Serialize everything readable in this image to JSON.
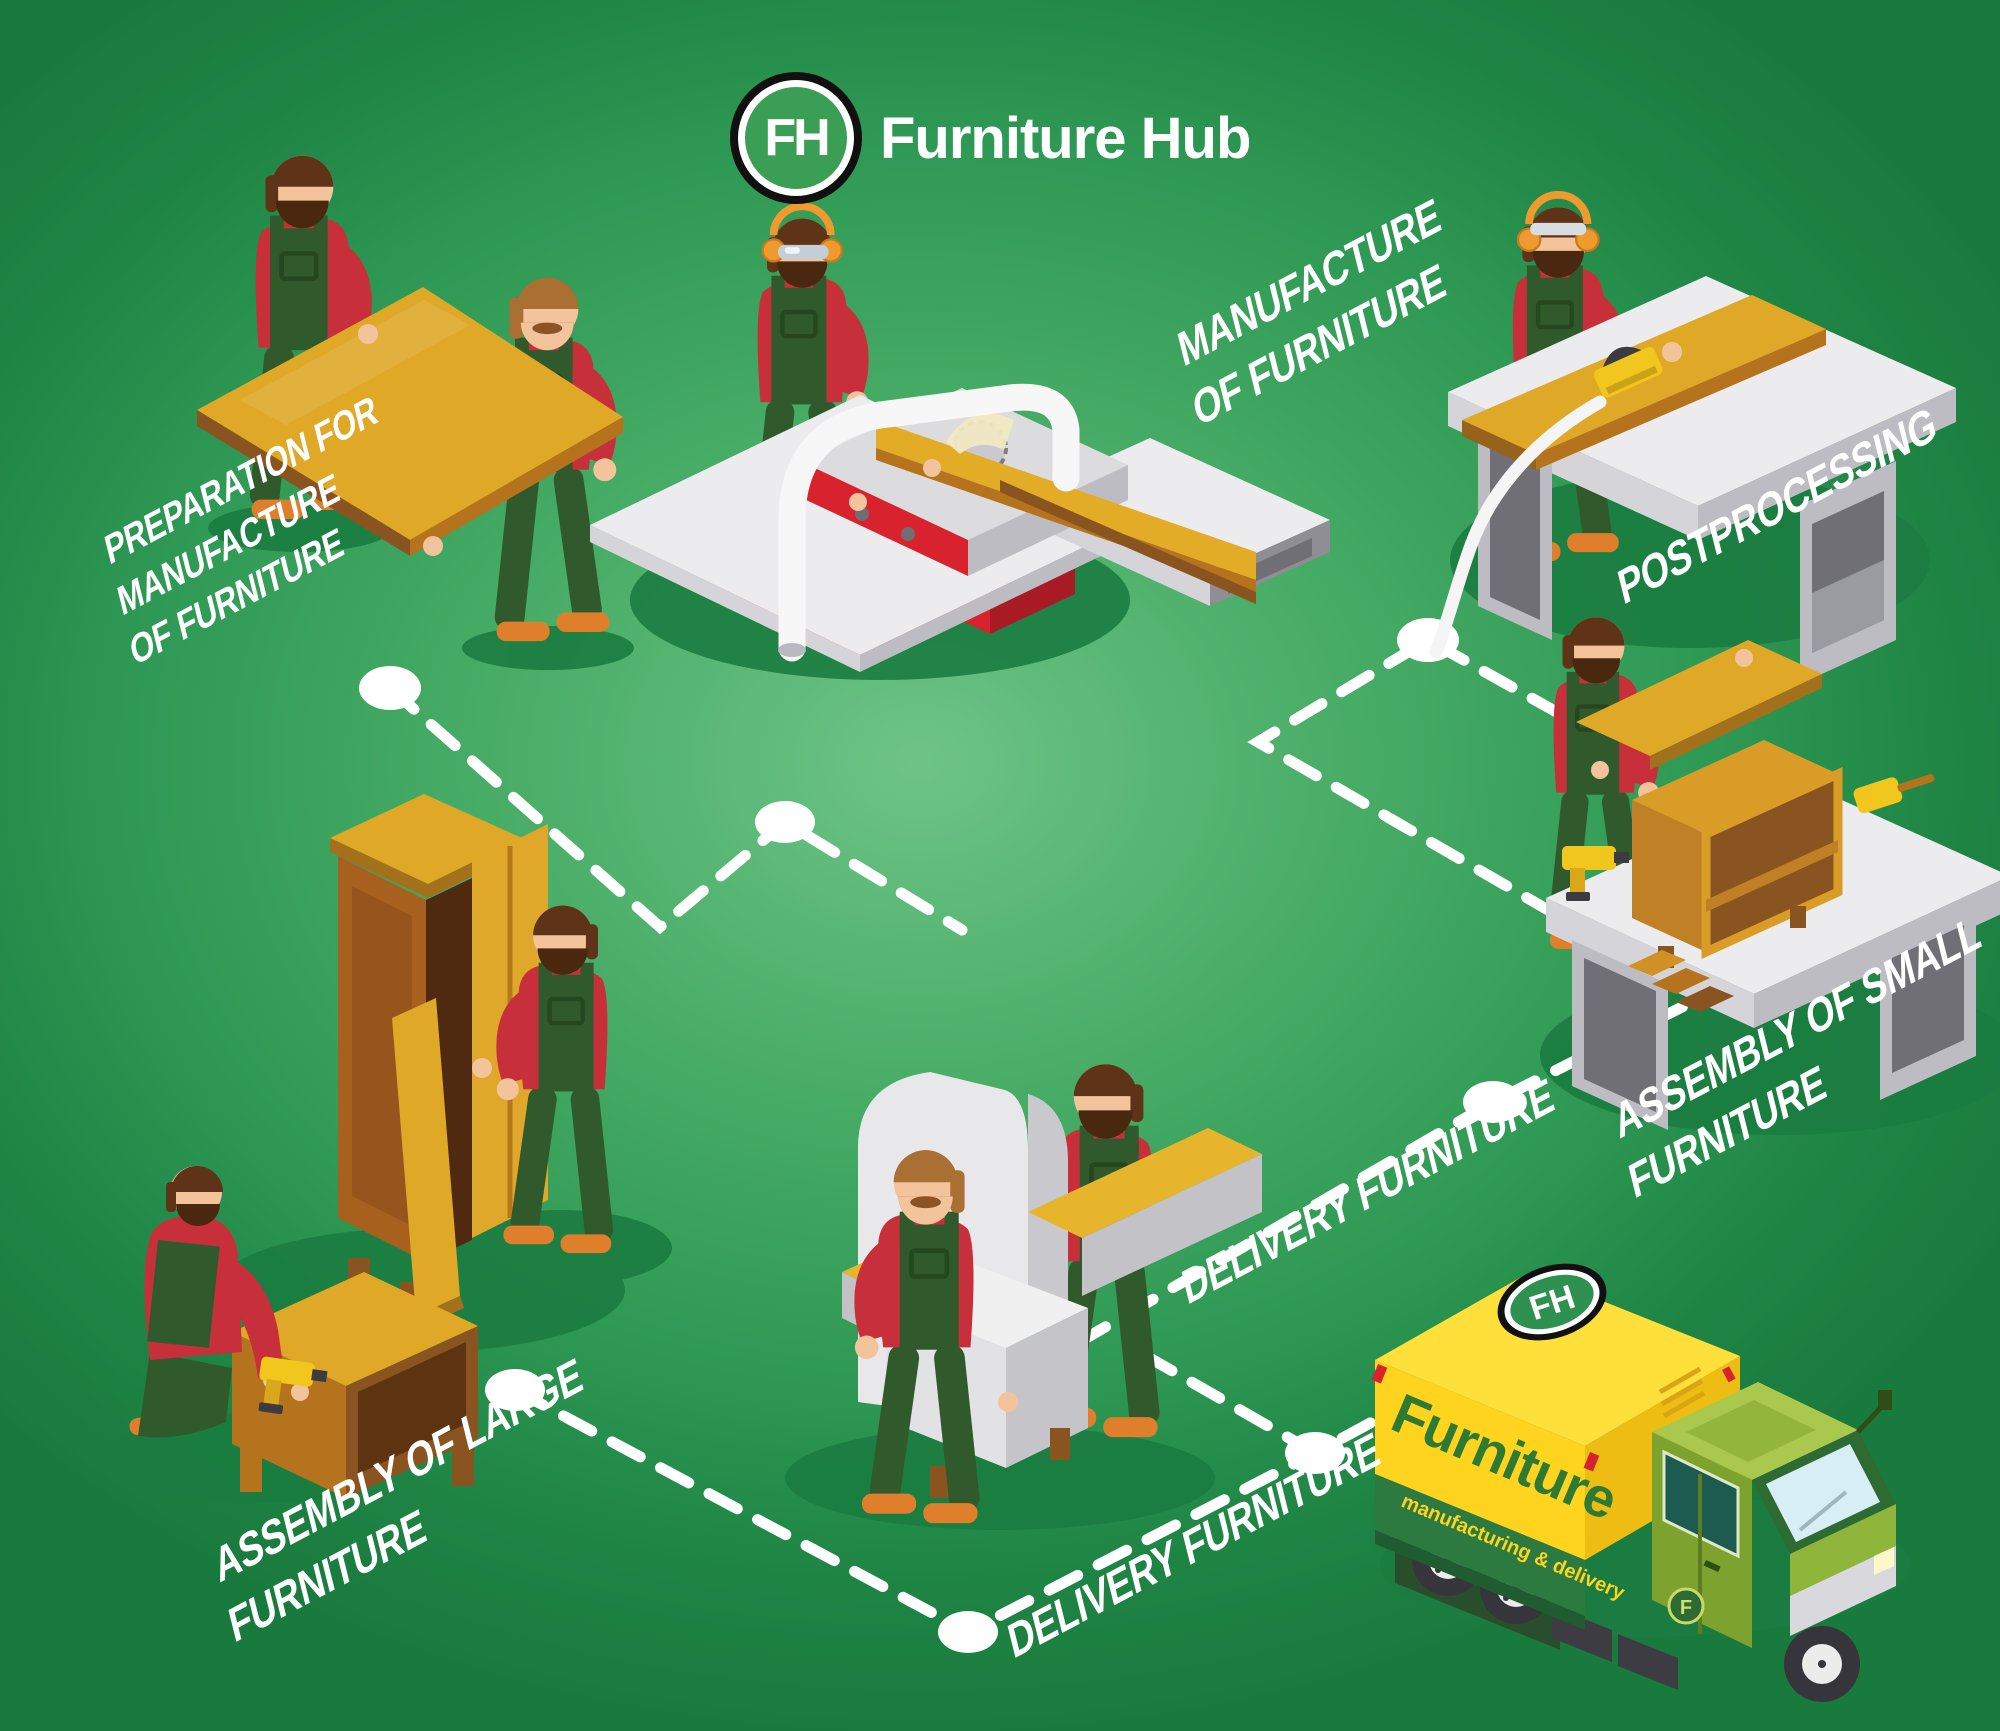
{
  "brand": {
    "initials": "FH",
    "name": "Furniture Hub"
  },
  "labels": {
    "preparation": {
      "lines": [
        "PREPARATION FOR",
        "MANUFACTURE",
        "OF FURNITURE"
      ]
    },
    "manufacture": {
      "lines": [
        "MANUFACTURE",
        "OF FURNITURE"
      ]
    },
    "postprocessing": {
      "lines": [
        "POSTPROCESSING"
      ]
    },
    "assembly_small": {
      "lines": [
        "ASSEMBLY OF SMALL",
        "FURNITURE"
      ]
    },
    "assembly_large": {
      "lines": [
        "ASSEMBLY OF LARGE",
        "FURNITURE"
      ]
    },
    "delivery_mid": {
      "lines": [
        "DELIVERY FURNITURE"
      ]
    },
    "delivery_bottom": {
      "lines": [
        "DELIVERY FURNITURE"
      ]
    }
  },
  "truck": {
    "side_text": "Furniture",
    "band_text": "manufacturing & delivery",
    "roof_logo": "FH",
    "door_badge": "F"
  },
  "colors": {
    "bg_center": "#6ec487",
    "bg_mid": "#2f9a55",
    "bg_edge": "#197a3d",
    "shadow": "#1b7c40",
    "white": "#ffffff",
    "logo_green": "#3a9e54",
    "shirt": "#c7303a",
    "overall": "#315a2c",
    "overall_dark": "#24471f",
    "skin": "#f3c49c",
    "hair": "#5f3317",
    "beard": "#4a280f",
    "hair_light": "#a96f33",
    "shoe": "#df7f2b",
    "wood_top": "#dfa826",
    "wood_mid": "#b5731d",
    "wood_dark": "#8a5420",
    "wood_deep": "#5e3312",
    "machine_red": "#d8232e",
    "machine_red_dark": "#a81b24",
    "gray_1": "#ececee",
    "gray_2": "#d5d5d9",
    "gray_3": "#bcbcc2",
    "gray_4": "#8e8e94",
    "gray_5": "#6f6f75",
    "tool_yellow": "#f2c71d",
    "truck_yellow": "#ffd41f",
    "truck_yellow_top": "#ffe03a",
    "truck_yellow_side": "#eebd13",
    "truck_green": "#2c7a3f",
    "truck_text_green": "#2e7a33",
    "cab_light": "#aac84e",
    "cab_side": "#7da32e",
    "cab_dark": "#2e6b33",
    "glass": "#d8eef5",
    "window_teal": "#1d5b50",
    "tire": "#35353b",
    "rim": "#ececec"
  }
}
